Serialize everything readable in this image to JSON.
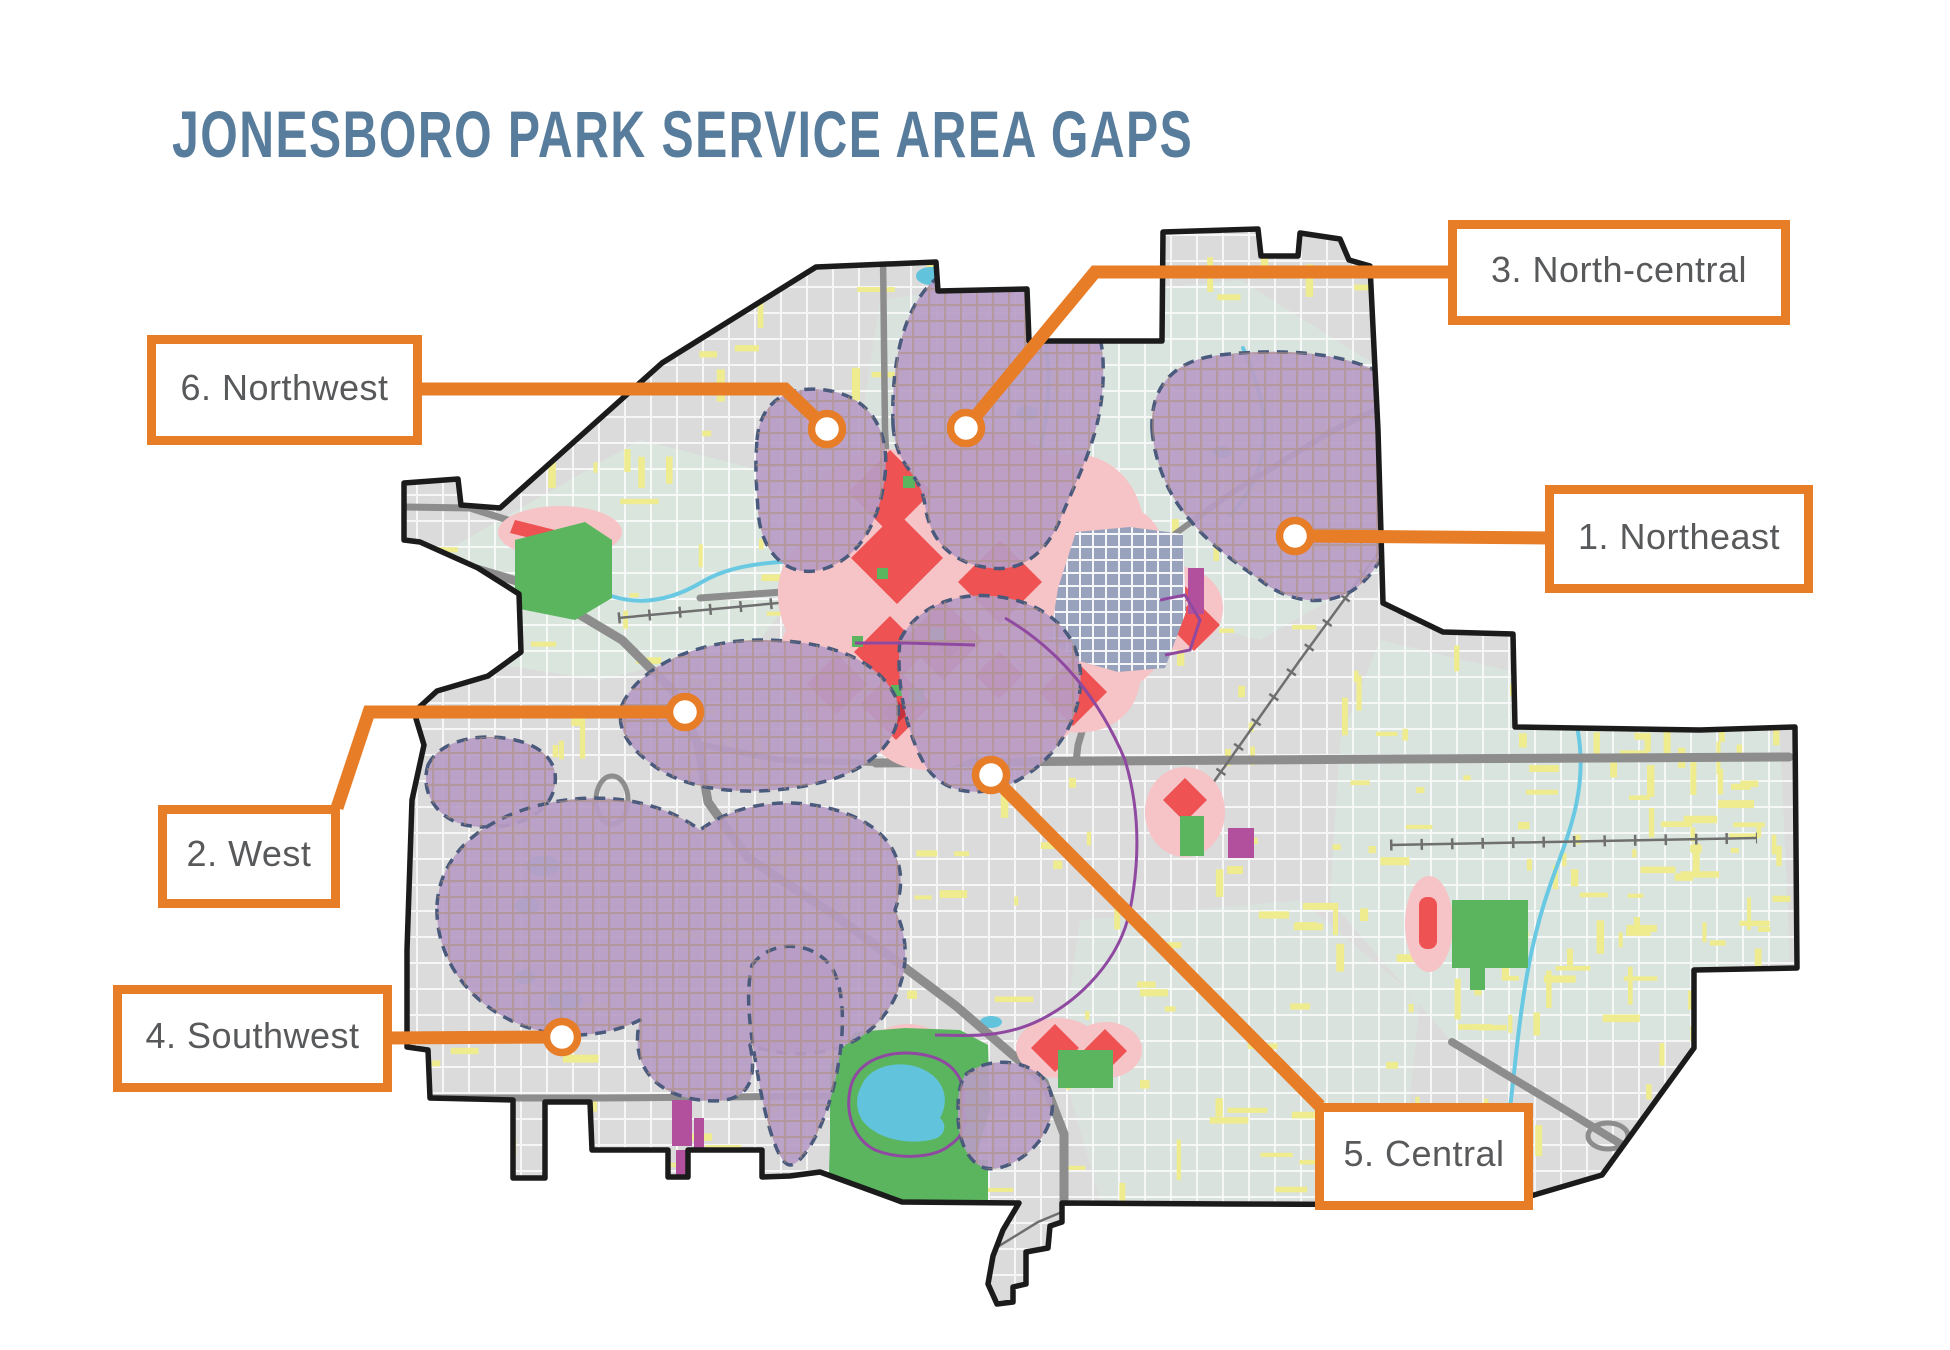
{
  "title": "JONESBORO PARK SERVICE AREA GAPS",
  "callouts": {
    "northeast": {
      "number": 1,
      "label": "1. Northeast"
    },
    "west": {
      "number": 2,
      "label": "2. West"
    },
    "north_central": {
      "number": 3,
      "label": "3. North-central"
    },
    "southwest": {
      "number": 4,
      "label": "4. Southwest"
    },
    "central": {
      "number": 5,
      "label": "5. Central"
    },
    "northwest": {
      "number": 6,
      "label": "6. Northwest"
    }
  },
  "colors": {
    "accent_orange": "#E87D28",
    "title_blue": "#587C9B",
    "label_gray": "#58595B",
    "gap_area_purple": "#B79CC6",
    "gap_border_navy": "#4A5A7C",
    "high_need_red": "#EE5253",
    "high_need_halo_pink": "#F6C3C6",
    "park_green": "#5BB55F",
    "water_cyan": "#6AC9E2",
    "downtown_blue_gray": "#98A2BC",
    "road_gray": "#8D8D8D",
    "minor_road_yellow": "#EFEC8F",
    "city_land_gray": "#DBDBDB"
  }
}
